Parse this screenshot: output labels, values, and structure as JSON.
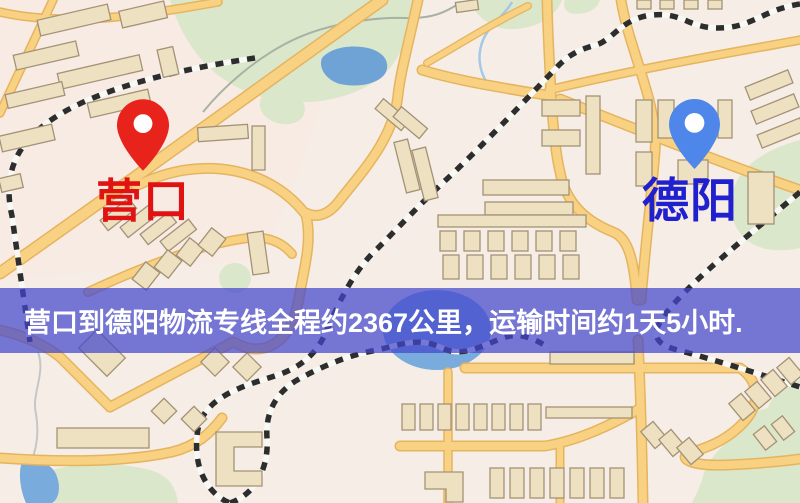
{
  "banner": {
    "text": "营口到德阳物流专线全程约2367公里，运输时间约1天5小时.",
    "background_color": "#4246cd",
    "background_opacity": 0.72,
    "text_color": "#ffffff"
  },
  "route": {
    "origin": "营口",
    "destination": "德阳",
    "distance_text": "约2367公里",
    "duration_text": "约1天5小时"
  },
  "markers": {
    "origin": {
      "label": "营口",
      "pin_icon": "red-location-pin",
      "pin_color": "#e8231b",
      "label_color": "#e01212"
    },
    "destination": {
      "label": "德阳",
      "pin_icon": "blue-location-pin",
      "pin_color": "#4f86ea",
      "label_color": "#2020cf"
    }
  },
  "map_palette": {
    "background": "#f6eee6",
    "residential_tint": "#f8ebe4",
    "road_fill": "#f9d182",
    "road_casing": "#e5b45f",
    "park_green": "#dbe7ca",
    "water_blue": "#79abdc",
    "lake_blue": "#6fa3d6",
    "building_fill": "#eee1c2",
    "building_stroke": "#a39276",
    "railway_dark": "#2d2d2d",
    "railway_light": "#f8f8f5"
  }
}
